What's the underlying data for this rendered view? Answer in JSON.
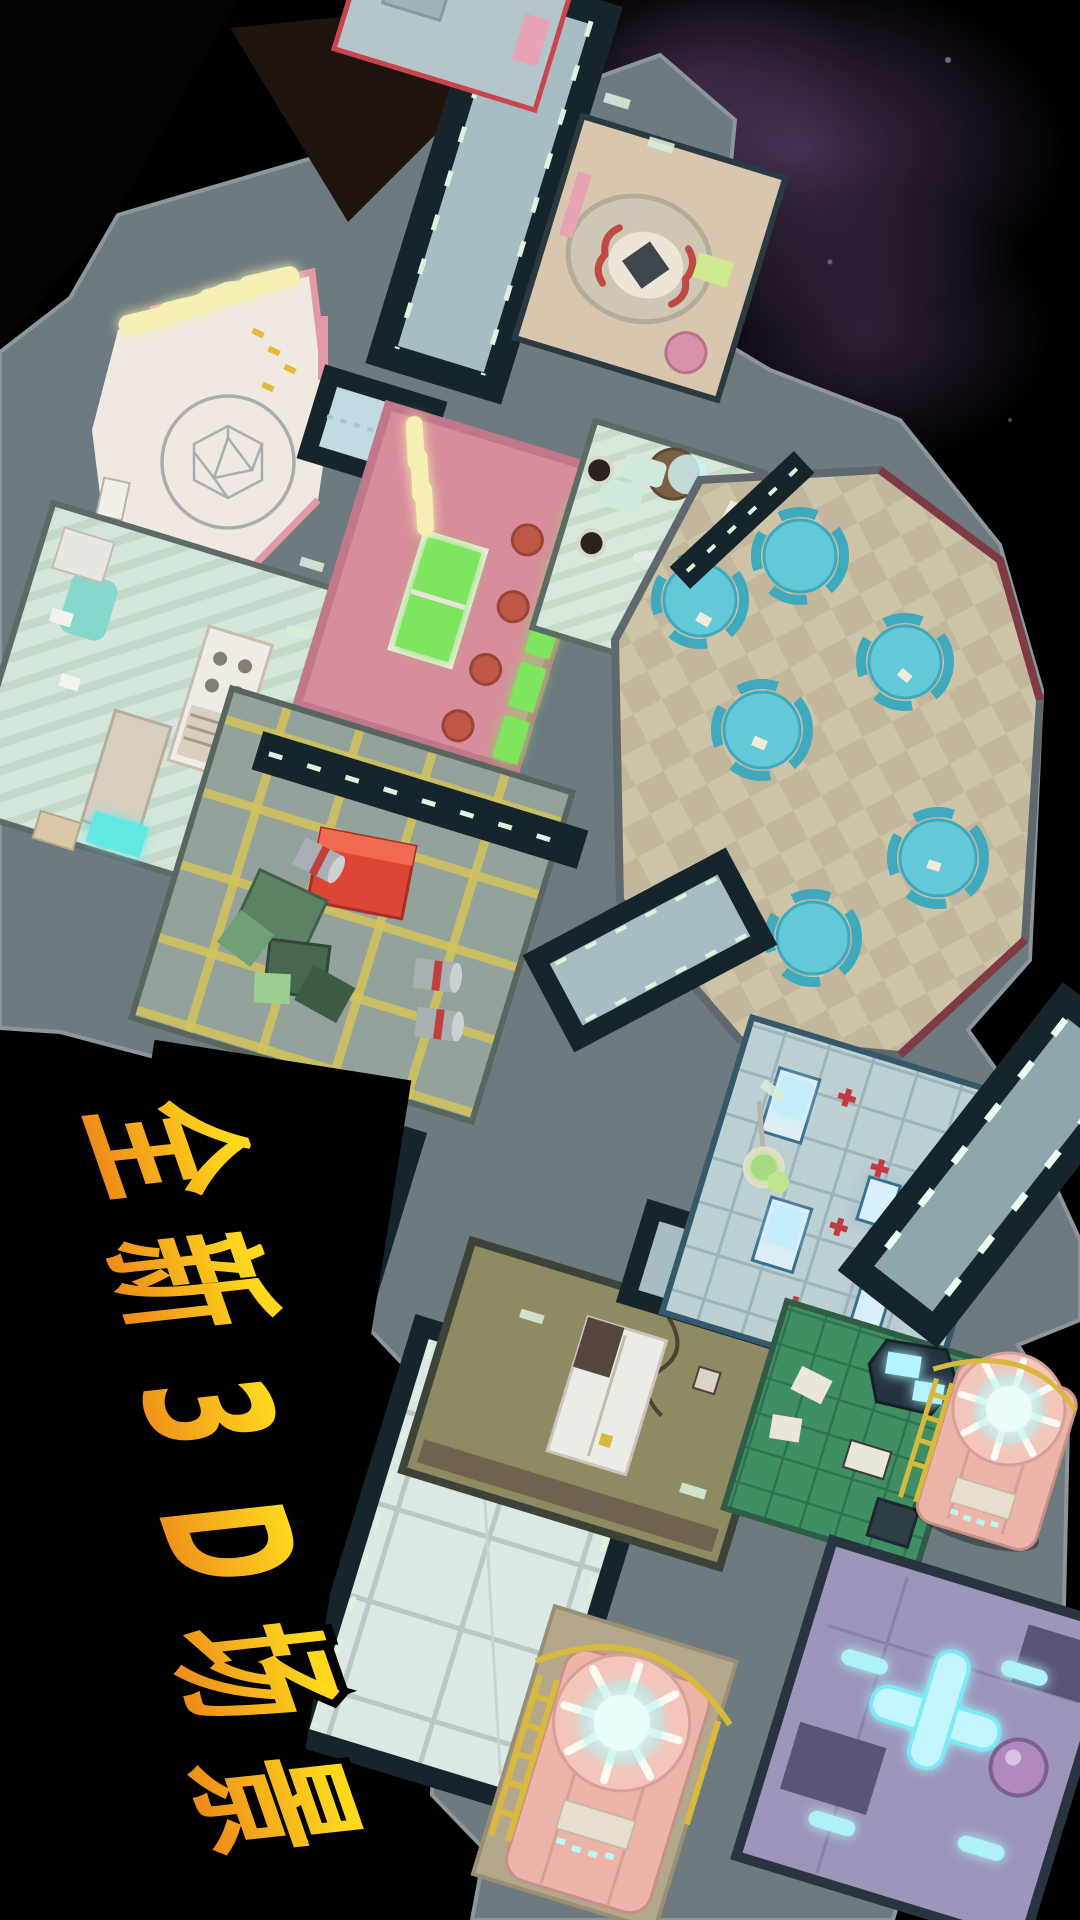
{
  "banner": {
    "text": "全新3D场景",
    "characters": [
      "全",
      "新",
      "3",
      "D",
      "场",
      "景"
    ],
    "meaning_note": "promo headline on left side of key art",
    "outline_color": "#000000"
  },
  "palette": {
    "space": "#000000",
    "nebula": "#7a5590",
    "hull": "#6d7a7f",
    "hullEdge": "#8b979c",
    "corridorWall": "#16242c",
    "corridorFloor": "#a7bdc3",
    "corridorLight": "#dff2e0",
    "lab": "#efe9e2",
    "labTrim": "#e39aa6",
    "scanner": "#d9c6af",
    "office": "#d4e6da",
    "officeStripe": "#c3dacb",
    "pink": "#d78d9b",
    "lounge": "#d7e8da",
    "caf": "#cec4a8",
    "cafDiamond": "#c2b79c",
    "tableCyan": "#63c8d8",
    "tableCyanDark": "#3fa9bd",
    "storage": "#93a29a",
    "storageLine": "#d2c35a",
    "crateGreen": "#5c8263",
    "crateRed": "#dc4636",
    "khaki": "#8e8a62",
    "medbay": "#bdd0d4",
    "medbayLine": "#9cb5ba",
    "greenhouse": "#3f8f63",
    "bay": "#dce8e4",
    "engine": "#9d95ba",
    "reactorBody": "#edb4aa",
    "reactorGlow": "#aef2f4",
    "ladder": "#d8b93e",
    "lightYellow": "#f6f0b4",
    "screenGreen": "#7ee55e",
    "g1": "#ffd81e",
    "g2": "#ee8c1a"
  },
  "scene": {
    "description_rooms": [
      {
        "name": "laboratory"
      },
      {
        "name": "scanner-room"
      },
      {
        "name": "office"
      },
      {
        "name": "recreation-room"
      },
      {
        "name": "lounge"
      },
      {
        "name": "cafeteria"
      },
      {
        "name": "storage"
      },
      {
        "name": "kitchen"
      },
      {
        "name": "medbay"
      },
      {
        "name": "greenhouse"
      },
      {
        "name": "cargo-bay"
      },
      {
        "name": "engine-room"
      },
      {
        "name": "reactor-right"
      },
      {
        "name": "reactor-bottom"
      }
    ]
  }
}
